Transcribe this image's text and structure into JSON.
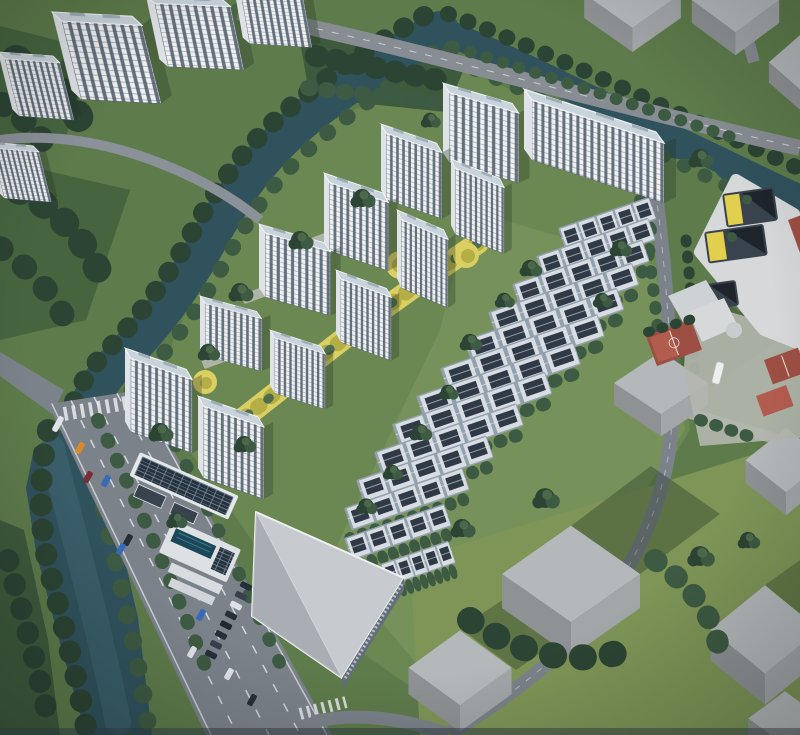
{
  "meta": {
    "type": "architectural-aerial-rendering",
    "subject": "residential-development-masterplan",
    "canvas": {
      "width": 800,
      "height": 735
    }
  },
  "palette": {
    "water": "#30525d",
    "water-light": "#4a7480",
    "tree-dark": "#2c4434",
    "tree-mid": "#3d5a42",
    "tree-light": "#4f6d4d",
    "forest": "#3d5a3c",
    "grass": "#5e7b4b",
    "grass-dark": "#46653f",
    "grass-mid": "#76925a",
    "grass-light": "#6c8852",
    "grass-yellow": "#7e9557",
    "road": "#7b828a",
    "road-light": "#878d93",
    "lane": "#e9ecef",
    "facade": "#eef0f2",
    "facade-side": "#dfe3e7",
    "window": "#4e5b69",
    "roof": "#c9d3db",
    "roof-edge": "#f2f5f7",
    "row-roof": "#93a1ad",
    "row-unit": "#d7dde2",
    "row-panel": "#2f3a46",
    "mass-top": "#b5b8bb",
    "mass-side": "#8e9295",
    "mass-side2": "#a2a6a9",
    "shadow": "#203122",
    "yellow": "#d9cf63",
    "yellow-deep": "#b3ae45",
    "court-red": "#9e4f44",
    "court-red-light": "#b25c4e",
    "school-white": "#d6d8da",
    "courtyard": "#39434d",
    "accent-yellow": "#e3cf4e",
    "plaza": "#b4b7ae",
    "solar": "#26323e",
    "pool": "#1c4758",
    "concrete": "#c7cbd0",
    "concrete-shade": "#8f959d",
    "car-orange": "#d98a2e",
    "car-blue": "#3a6ab5",
    "car-dark": "#262e38",
    "car-white": "#dfe3e8",
    "car-red": "#7a2d35"
  },
  "scene": {
    "water_bodies": [
      "canal",
      "canal-arm",
      "river"
    ],
    "residential_towers": {
      "count": 12,
      "style": "white-facade-glass-stripes"
    },
    "townhouse_rows": {
      "count": 13,
      "style": "dark-roof-solar-panels"
    },
    "context_buildings": {
      "top_left_slabs": 5,
      "massing_blocks": 9
    },
    "school_campus": {
      "courtyards": 3,
      "sports_courts": 4
    },
    "roads": {
      "main_road_lanes": 8,
      "crosswalks": 2
    },
    "vehicles": {
      "on_road": 10,
      "parked": 8
    },
    "amenities": [
      "clubhouse-solar-roof",
      "swimming-pool",
      "commercial-building",
      "yellow-linear-park"
    ]
  }
}
